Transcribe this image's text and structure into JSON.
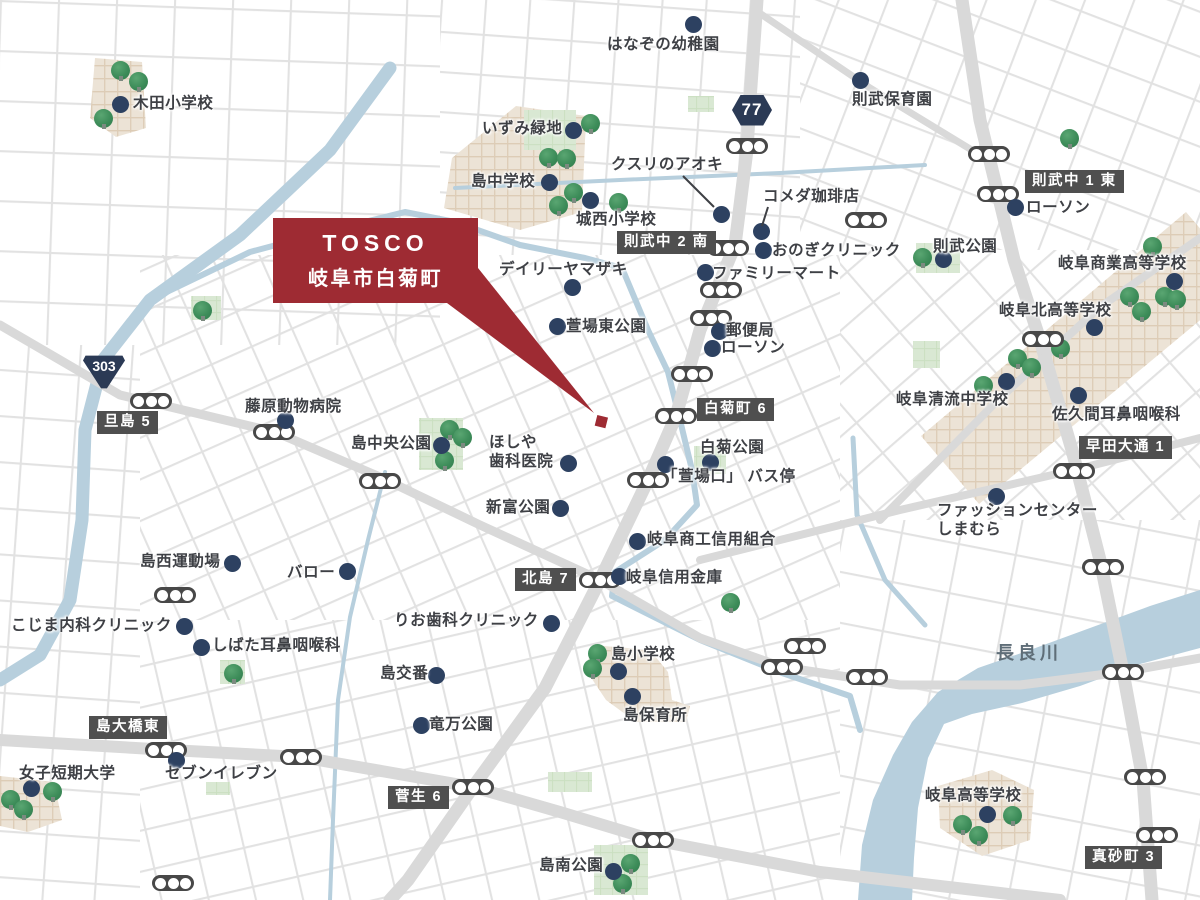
{
  "callout": {
    "title": "TOSCO",
    "subtitle": "岐阜市白菊町"
  },
  "colors": {
    "accent_red": "#9e2b33",
    "poi_dot": "#2d4161",
    "badge_bg": "#4f4f4f",
    "shield_bg": "#2b3a55",
    "water": "#b7cfdd",
    "tree_green": "#3d8c59",
    "street": "#e2e2e2",
    "main_road": "#d9d9d9",
    "campus": "#ece3d6",
    "park": "#d9e8d3"
  },
  "route_shields": [
    {
      "number": "77",
      "shape": "hex",
      "x": 752,
      "y": 110
    },
    {
      "number": "303",
      "shape": "tri",
      "x": 103,
      "y": 371
    }
  ],
  "intersection_badges": [
    {
      "label": "則武中 2 南",
      "x": 617,
      "y": 231
    },
    {
      "label": "則武中 1 東",
      "x": 1025,
      "y": 170
    },
    {
      "label": "白菊町 6",
      "x": 697,
      "y": 398
    },
    {
      "label": "旦島 5",
      "x": 97,
      "y": 411
    },
    {
      "label": "早田大通 1",
      "x": 1079,
      "y": 436
    },
    {
      "label": "北島 7",
      "x": 515,
      "y": 568
    },
    {
      "label": "島大橋東",
      "x": 89,
      "y": 716
    },
    {
      "label": "菅生 6",
      "x": 388,
      "y": 786
    },
    {
      "label": "真砂町 3",
      "x": 1085,
      "y": 846
    }
  ],
  "pois": [
    {
      "label": "木田小学校",
      "lx": 133,
      "ly": 95,
      "dx": 120,
      "dy": 104
    },
    {
      "label": "はなぞの幼稚園",
      "lx": 607,
      "ly": 36,
      "dx": 693,
      "dy": 24
    },
    {
      "label": "いずみ緑地",
      "lx": 482,
      "ly": 120,
      "dx": 573,
      "dy": 130
    },
    {
      "label": "島中学校",
      "lx": 471,
      "ly": 173,
      "dx": 549,
      "dy": 182
    },
    {
      "label": "城西小学校",
      "lx": 576,
      "ly": 211,
      "dx": 590,
      "dy": 200
    },
    {
      "label": "クスリのアオキ",
      "lx": 611,
      "ly": 156,
      "dx": 721,
      "dy": 214,
      "leader": [
        683,
        176,
        714,
        207
      ]
    },
    {
      "label": "コメダ珈琲店",
      "lx": 763,
      "ly": 188,
      "dx": 761,
      "dy": 231,
      "leader": [
        768,
        207,
        762,
        226
      ]
    },
    {
      "label": "おのぎクリニック",
      "lx": 772,
      "ly": 242,
      "dx": 763,
      "dy": 250
    },
    {
      "label": "ファミリーマート",
      "lx": 712,
      "ly": 265,
      "dx": 705,
      "dy": 272
    },
    {
      "label": "則武保育園",
      "lx": 852,
      "ly": 91,
      "dx": 860,
      "dy": 80
    },
    {
      "label": "ローソン",
      "lx": 1026,
      "ly": 199,
      "dx": 1015,
      "dy": 207
    },
    {
      "label": "則武公園",
      "lx": 933,
      "ly": 238,
      "dx": 943,
      "dy": 259
    },
    {
      "label": "岐阜商業高等学校",
      "lx": 1058,
      "ly": 255,
      "dx": 1174,
      "dy": 281
    },
    {
      "label": "岐阜北高等学校",
      "lx": 999,
      "ly": 302,
      "dx": 1094,
      "dy": 327
    },
    {
      "label": "岐阜清流中学校",
      "lx": 896,
      "ly": 391,
      "dx": 1006,
      "dy": 381
    },
    {
      "label": "佐久間耳鼻咽喉科",
      "lx": 1052,
      "ly": 406,
      "dx": 1078,
      "dy": 395
    },
    {
      "label": "デイリーヤマザキ",
      "lx": 499,
      "ly": 261,
      "dx": 572,
      "dy": 287
    },
    {
      "label": "萱場東公園",
      "lx": 566,
      "ly": 318,
      "dx": 557,
      "dy": 326
    },
    {
      "label": "郵便局",
      "lx": 726,
      "ly": 322,
      "dx": 719,
      "dy": 331
    },
    {
      "label": "ローソン",
      "lx": 721,
      "ly": 339,
      "dx": 712,
      "dy": 348
    },
    {
      "label": "白菊公園",
      "lx": 700,
      "ly": 439,
      "dx": 710,
      "dy": 462
    },
    {
      "label": "「萱場口」 バス停",
      "lx": 662,
      "ly": 468,
      "dx": 665,
      "dy": 464
    },
    {
      "label": "藤原動物病院",
      "lx": 245,
      "ly": 398,
      "dx": 285,
      "dy": 420
    },
    {
      "label": "島中央公園",
      "lx": 351,
      "ly": 435,
      "dx": 441,
      "dy": 445
    },
    {
      "label": "ほしや\n歯科医院",
      "lx": 489,
      "ly": 434,
      "dx": 568,
      "dy": 463
    },
    {
      "label": "新富公園",
      "lx": 486,
      "ly": 499,
      "dx": 560,
      "dy": 508
    },
    {
      "label": "岐阜商工信用組合",
      "lx": 647,
      "ly": 531,
      "dx": 637,
      "dy": 541
    },
    {
      "label": "岐阜信用金庫",
      "lx": 626,
      "ly": 569,
      "dx": 619,
      "dy": 576
    },
    {
      "label": "りお歯科クリニック",
      "lx": 394,
      "ly": 612,
      "dx": 551,
      "dy": 623
    },
    {
      "label": "島西運動場",
      "lx": 140,
      "ly": 553,
      "dx": 232,
      "dy": 563
    },
    {
      "label": "バロー",
      "lx": 287,
      "ly": 564,
      "dx": 347,
      "dy": 571
    },
    {
      "label": "こじま内科クリニック",
      "lx": 11,
      "ly": 617,
      "dx": 184,
      "dy": 626
    },
    {
      "label": "しばた耳鼻咽喉科",
      "lx": 212,
      "ly": 637,
      "dx": 201,
      "dy": 647
    },
    {
      "label": "島交番",
      "lx": 380,
      "ly": 665,
      "dx": 436,
      "dy": 675
    },
    {
      "label": "竜万公園",
      "lx": 429,
      "ly": 716,
      "dx": 421,
      "dy": 725
    },
    {
      "label": "島小学校",
      "lx": 611,
      "ly": 646,
      "dx": 618,
      "dy": 671
    },
    {
      "label": "島保育所",
      "lx": 623,
      "ly": 707,
      "dx": 632,
      "dy": 696
    },
    {
      "label": "女子短期大学",
      "lx": 19,
      "ly": 765,
      "dx": 31,
      "dy": 788
    },
    {
      "label": "セブンイレブン",
      "lx": 165,
      "ly": 765,
      "dx": 176,
      "dy": 760
    },
    {
      "label": "島南公園",
      "lx": 539,
      "ly": 857,
      "dx": 613,
      "dy": 871
    },
    {
      "label": "岐阜高等学校",
      "lx": 925,
      "ly": 787,
      "dx": 987,
      "dy": 814
    },
    {
      "label": "ファッションセンター\nしまむら",
      "lx": 937,
      "ly": 502,
      "dx": 996,
      "dy": 496
    },
    {
      "label": "長良川",
      "lx": 996,
      "ly": 643,
      "river": true
    }
  ],
  "traffic_lights": [
    [
      989,
      154
    ],
    [
      998,
      194
    ],
    [
      747,
      146
    ],
    [
      866,
      220
    ],
    [
      728,
      248
    ],
    [
      721,
      290
    ],
    [
      711,
      318
    ],
    [
      692,
      374
    ],
    [
      676,
      416
    ],
    [
      648,
      480
    ],
    [
      1043,
      339
    ],
    [
      1074,
      471
    ],
    [
      1103,
      567
    ],
    [
      1123,
      672
    ],
    [
      867,
      677
    ],
    [
      782,
      667
    ],
    [
      805,
      646
    ],
    [
      1145,
      777
    ],
    [
      1157,
      835
    ],
    [
      151,
      401
    ],
    [
      274,
      432
    ],
    [
      380,
      481
    ],
    [
      600,
      580
    ],
    [
      175,
      595
    ],
    [
      166,
      750
    ],
    [
      301,
      757
    ],
    [
      473,
      787
    ],
    [
      653,
      840
    ],
    [
      173,
      883
    ]
  ],
  "trees": [
    [
      120,
      70
    ],
    [
      138,
      81
    ],
    [
      103,
      118
    ],
    [
      590,
      123
    ],
    [
      548,
      157
    ],
    [
      566,
      158
    ],
    [
      573,
      192
    ],
    [
      558,
      205
    ],
    [
      618,
      202
    ],
    [
      922,
      257
    ],
    [
      1069,
      138
    ],
    [
      1017,
      358
    ],
    [
      1031,
      367
    ],
    [
      1060,
      348
    ],
    [
      983,
      385
    ],
    [
      1129,
      296
    ],
    [
      1141,
      311
    ],
    [
      1164,
      296
    ],
    [
      1176,
      299
    ],
    [
      1152,
      246
    ],
    [
      962,
      824
    ],
    [
      978,
      835
    ],
    [
      1012,
      815
    ],
    [
      10,
      799
    ],
    [
      23,
      809
    ],
    [
      52,
      791
    ],
    [
      597,
      653
    ],
    [
      592,
      668
    ],
    [
      630,
      863
    ],
    [
      622,
      883
    ],
    [
      730,
      602
    ],
    [
      233,
      673
    ],
    [
      202,
      310
    ],
    [
      449,
      429
    ],
    [
      462,
      437
    ],
    [
      444,
      460
    ]
  ]
}
